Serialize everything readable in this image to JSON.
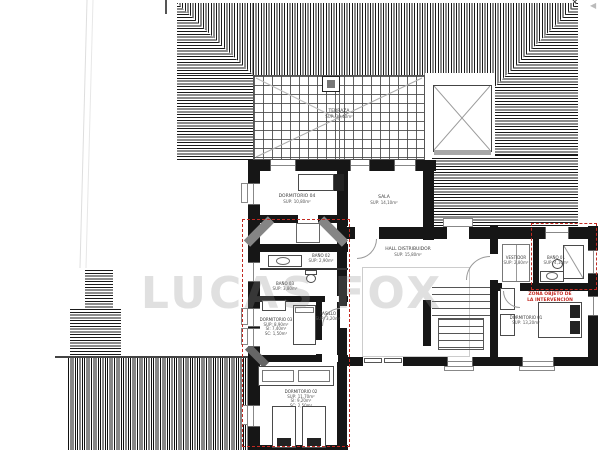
{
  "meta": {
    "watermark": "LUCAS FOX"
  },
  "marks": {
    "north_cross": "✕",
    "edge_arrow": "◀"
  },
  "red_zone": {
    "line1": "ZONA OBJETO DE",
    "line2": "LA INTERVENCIÓN"
  },
  "rooms": {
    "terraza": {
      "name": "TERRAZA",
      "sup": "SUP: 30,40m²"
    },
    "dorm04": {
      "name": "DORMITORIO 04",
      "sup": "SUP: 10,80m²"
    },
    "sala": {
      "name": "SALA",
      "sup": "SUP: 14,10m²"
    },
    "hall": {
      "name": "HALL DISTRIBUIDOR",
      "sup": "SUP: 15,80m²"
    },
    "bano02": {
      "name": "BAÑO 02",
      "sup": "SUP: 2,90m²"
    },
    "bano03": {
      "name": "BAÑO 03",
      "sup": "SUP: 3,80m²"
    },
    "pasillo": {
      "name": "PASILLO",
      "sup": "SUP: 3,20m²"
    },
    "dorm03": {
      "name": "DORMITORIO 03",
      "sup": "SUP: 8,90m²",
      "si": "SI: 7,40m²",
      "sc": "SC: 1,50m²"
    },
    "dorm02": {
      "name": "DORMITORIO 02",
      "sup": "SUP: 11,70m²",
      "si": "SI: 9,20m²",
      "sc": "SC: 2,50m²"
    },
    "dorm01": {
      "name": "DORMITORIO 01",
      "sup": "SUP: 13,20m²"
    },
    "vestidor": {
      "name": "VESTIDOR",
      "sup": "SUP: 2,80m²"
    },
    "bano01": {
      "name": "BAÑO 01",
      "sup": "SUP: 4,10m²"
    }
  },
  "colors": {
    "wall": "#161616",
    "red": "#c22a22",
    "watermark_gray": "#8f8f8f"
  }
}
